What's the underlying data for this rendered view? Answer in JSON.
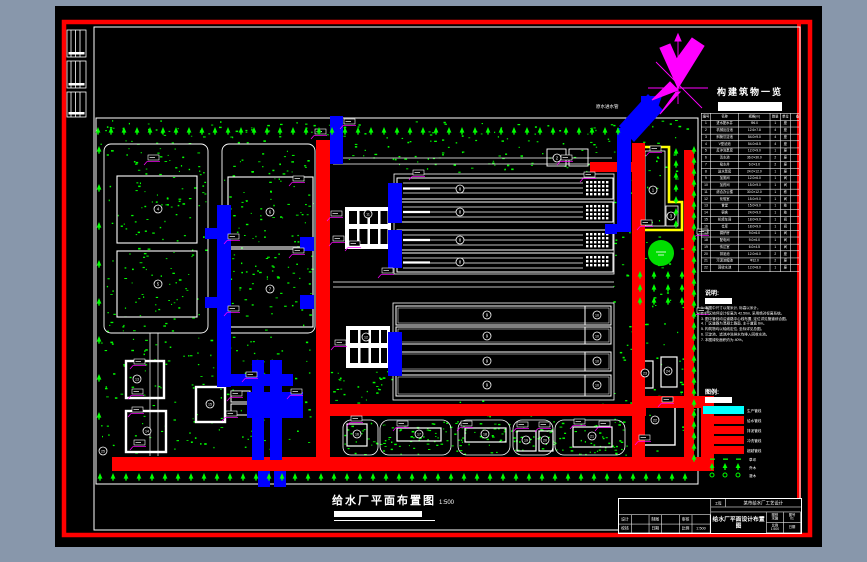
{
  "window": {
    "bg": "#8897ab"
  },
  "colors": {
    "red": "#ff0000",
    "blue": "#0000ff",
    "green": "#00ff00",
    "magenta": "#ff00ff",
    "yellow": "#ffff00",
    "cyan": "#00ffff"
  },
  "structures_table": {
    "title": "构建筑物一览",
    "headers": [
      "编号",
      "名称",
      "规格(m)",
      "数量",
      "单位",
      "备注"
    ],
    "rows": [
      [
        "1",
        "进水配水井",
        "Φ6.0",
        "1",
        "座",
        ""
      ],
      [
        "2",
        "机械反应池",
        "12.6×7.8",
        "4",
        "座",
        ""
      ],
      [
        "3",
        "斜管沉淀池",
        "54.0×9.0",
        "4",
        "座",
        ""
      ],
      [
        "4",
        "V型滤池",
        "54.0×8.5",
        "4",
        "座",
        ""
      ],
      [
        "5",
        "反冲洗泵房",
        "12.0×9.0",
        "1",
        "座",
        ""
      ],
      [
        "6",
        "清水池",
        "36.0×30.0",
        "2",
        "座",
        ""
      ],
      [
        "7",
        "吸水井",
        "6.0×3.0",
        "2",
        "座",
        ""
      ],
      [
        "8",
        "送水泵房",
        "24.0×12.0",
        "1",
        "座",
        ""
      ],
      [
        "9",
        "加氯间",
        "12.0×6.0",
        "1",
        "间",
        ""
      ],
      [
        "10",
        "加药间",
        "15.0×9.0",
        "1",
        "间",
        ""
      ],
      [
        "11",
        "综合办公楼",
        "30.0×12.0",
        "1",
        "栋",
        ""
      ],
      [
        "12",
        "化验室",
        "15.0×9.0",
        "1",
        "间",
        ""
      ],
      [
        "13",
        "食堂",
        "15.0×9.0",
        "1",
        "栋",
        ""
      ],
      [
        "14",
        "宿舍",
        "24.0×9.0",
        "1",
        "栋",
        ""
      ],
      [
        "15",
        "机修车间",
        "18.0×9.0",
        "1",
        "间",
        ""
      ],
      [
        "16",
        "仓库",
        "18.0×9.0",
        "1",
        "间",
        ""
      ],
      [
        "17",
        "锅炉房",
        "9.0×6.0",
        "1",
        "间",
        ""
      ],
      [
        "18",
        "配电间",
        "9.0×6.0",
        "1",
        "间",
        ""
      ],
      [
        "19",
        "传达室",
        "6.0×4.5",
        "1",
        "间",
        ""
      ],
      [
        "20",
        "排泥池",
        "12.0×6.0",
        "2",
        "座",
        ""
      ],
      [
        "21",
        "污泥浓缩池",
        "Φ12.0",
        "2",
        "座",
        ""
      ],
      [
        "22",
        "回收水池",
        "12.0×8.0",
        "1",
        "座",
        ""
      ]
    ]
  },
  "notes": {
    "title": "说明:",
    "items": [
      "1. 本图中尺寸以毫米计, 标高以米计。",
      "2. 厂区地坪设计标高为 42.50m, 采用绝对标高系统。",
      "3. 图中管线均沿道路中心线布置, 定位详见管道综合图。",
      "4. 厂区道路为混凝土路面, 主干道宽 6m。",
      "5. 构筑物均以轴线定位, 坐标详见总图。",
      "6. 沉淀池、滤池冲洗排水均排入回收水池。",
      "7. 本图绿化面积约为 40%。"
    ]
  },
  "legend": {
    "title": "图例:",
    "items": [
      {
        "label": "生产管线",
        "color": "#00ffff"
      },
      {
        "label": "给水管线",
        "color": "#ff0000"
      },
      {
        "label": "排泥管线",
        "color": "#ff0000"
      },
      {
        "label": "冲洗管线",
        "color": "#ff0000"
      },
      {
        "label": "超越管线",
        "color": "#ff0000"
      }
    ],
    "symbols": [
      {
        "label": "草坪",
        "type": "grass"
      },
      {
        "label": "乔木",
        "type": "tree"
      },
      {
        "label": "灌木",
        "type": "shrub"
      }
    ]
  },
  "main_title": {
    "text": "给水厂平面布置图",
    "scale": "1:500"
  },
  "title_block": {
    "project_label": "工程",
    "project": "某市给水厂工艺设计",
    "drawing_name": "给水厂平面设计布置图",
    "fields": [
      [
        "设计",
        ""
      ],
      [
        "制图",
        ""
      ],
      [
        "审核",
        ""
      ],
      [
        "校核",
        ""
      ],
      [
        "日期",
        ""
      ],
      [
        "比例",
        "1:500"
      ]
    ],
    "right_cells": [
      {
        "label": "图别",
        "value": "水施"
      },
      {
        "label": "图号",
        "value": "01"
      },
      {
        "label": "比例",
        "value": "1:500"
      },
      {
        "label": "日期",
        "value": ""
      }
    ]
  },
  "plan": {
    "pipe_label": "原水进水管",
    "markers": [
      {
        "n": "4",
        "x": 158,
        "y": 209
      },
      {
        "n": "5",
        "x": 158,
        "y": 284
      },
      {
        "n": "6",
        "x": 270,
        "y": 212
      },
      {
        "n": "7",
        "x": 270,
        "y": 289
      },
      {
        "n": "8",
        "x": 460,
        "y": 189
      },
      {
        "n": "8",
        "x": 460,
        "y": 212
      },
      {
        "n": "8",
        "x": 460,
        "y": 240
      },
      {
        "n": "8",
        "x": 460,
        "y": 262
      },
      {
        "n": "9",
        "x": 487,
        "y": 315
      },
      {
        "n": "9",
        "x": 487,
        "y": 336
      },
      {
        "n": "9",
        "x": 487,
        "y": 361
      },
      {
        "n": "9",
        "x": 487,
        "y": 385
      },
      {
        "n": "10",
        "x": 597,
        "y": 315
      },
      {
        "n": "10",
        "x": 597,
        "y": 336
      },
      {
        "n": "10",
        "x": 597,
        "y": 361
      },
      {
        "n": "10",
        "x": 597,
        "y": 385
      },
      {
        "n": "11",
        "x": 368,
        "y": 214
      },
      {
        "n": "12",
        "x": 366,
        "y": 337
      },
      {
        "n": "1",
        "x": 653,
        "y": 190
      },
      {
        "n": "2",
        "x": 557,
        "y": 158
      },
      {
        "n": "3",
        "x": 671,
        "y": 216
      },
      {
        "n": "13",
        "x": 137,
        "y": 379
      },
      {
        "n": "14",
        "x": 147,
        "y": 431
      },
      {
        "n": "15",
        "x": 210,
        "y": 404
      },
      {
        "n": "16",
        "x": 357,
        "y": 434
      },
      {
        "n": "17",
        "x": 419,
        "y": 434
      },
      {
        "n": "18",
        "x": 485,
        "y": 434
      },
      {
        "n": "19",
        "x": 526,
        "y": 440
      },
      {
        "n": "20",
        "x": 545,
        "y": 440
      },
      {
        "n": "21",
        "x": 592,
        "y": 436
      },
      {
        "n": "22",
        "x": 655,
        "y": 420
      },
      {
        "n": "23",
        "x": 645,
        "y": 373
      },
      {
        "n": "24",
        "x": 668,
        "y": 371
      },
      {
        "n": "25",
        "x": 103,
        "y": 451
      }
    ]
  }
}
